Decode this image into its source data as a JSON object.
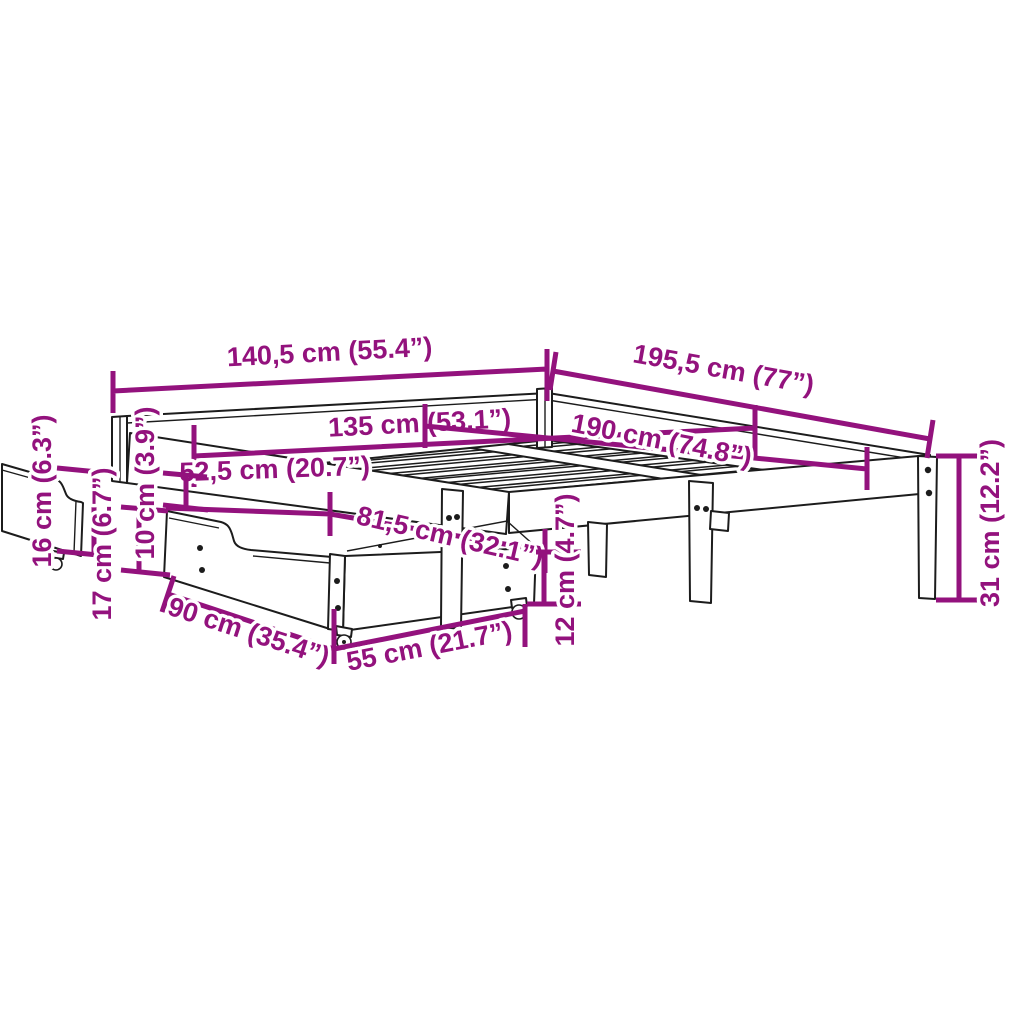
{
  "diagram": {
    "type": "bed-frame-with-storage-drawers-dimension-diagram",
    "background_color": "#ffffff",
    "dimension_color": "#93127D",
    "line_color": "#1c1c1c",
    "dimensions": {
      "overall_width": "140,5 cm (55.4”)",
      "overall_length": "195,5 cm (77”)",
      "slat_area_width": "135 cm (53.1”)",
      "slat_area_length": "190 cm (74.8”)",
      "drawer_offset": "52,5 cm (20.7”)",
      "drawer_reach": "81,5 cm (32.1”)",
      "underbed_clearance": "16 cm (6.3”)",
      "rail_height": "10 cm (3.9”)",
      "drawer_total_height": "17 cm (6.7”)",
      "drawer_side_height": "12 cm (4.7”)",
      "leg_height": "31 cm (12.2”)",
      "drawer_depth": "90 cm (35.4”)",
      "drawer_width": "55 cm (21.7”)"
    }
  }
}
